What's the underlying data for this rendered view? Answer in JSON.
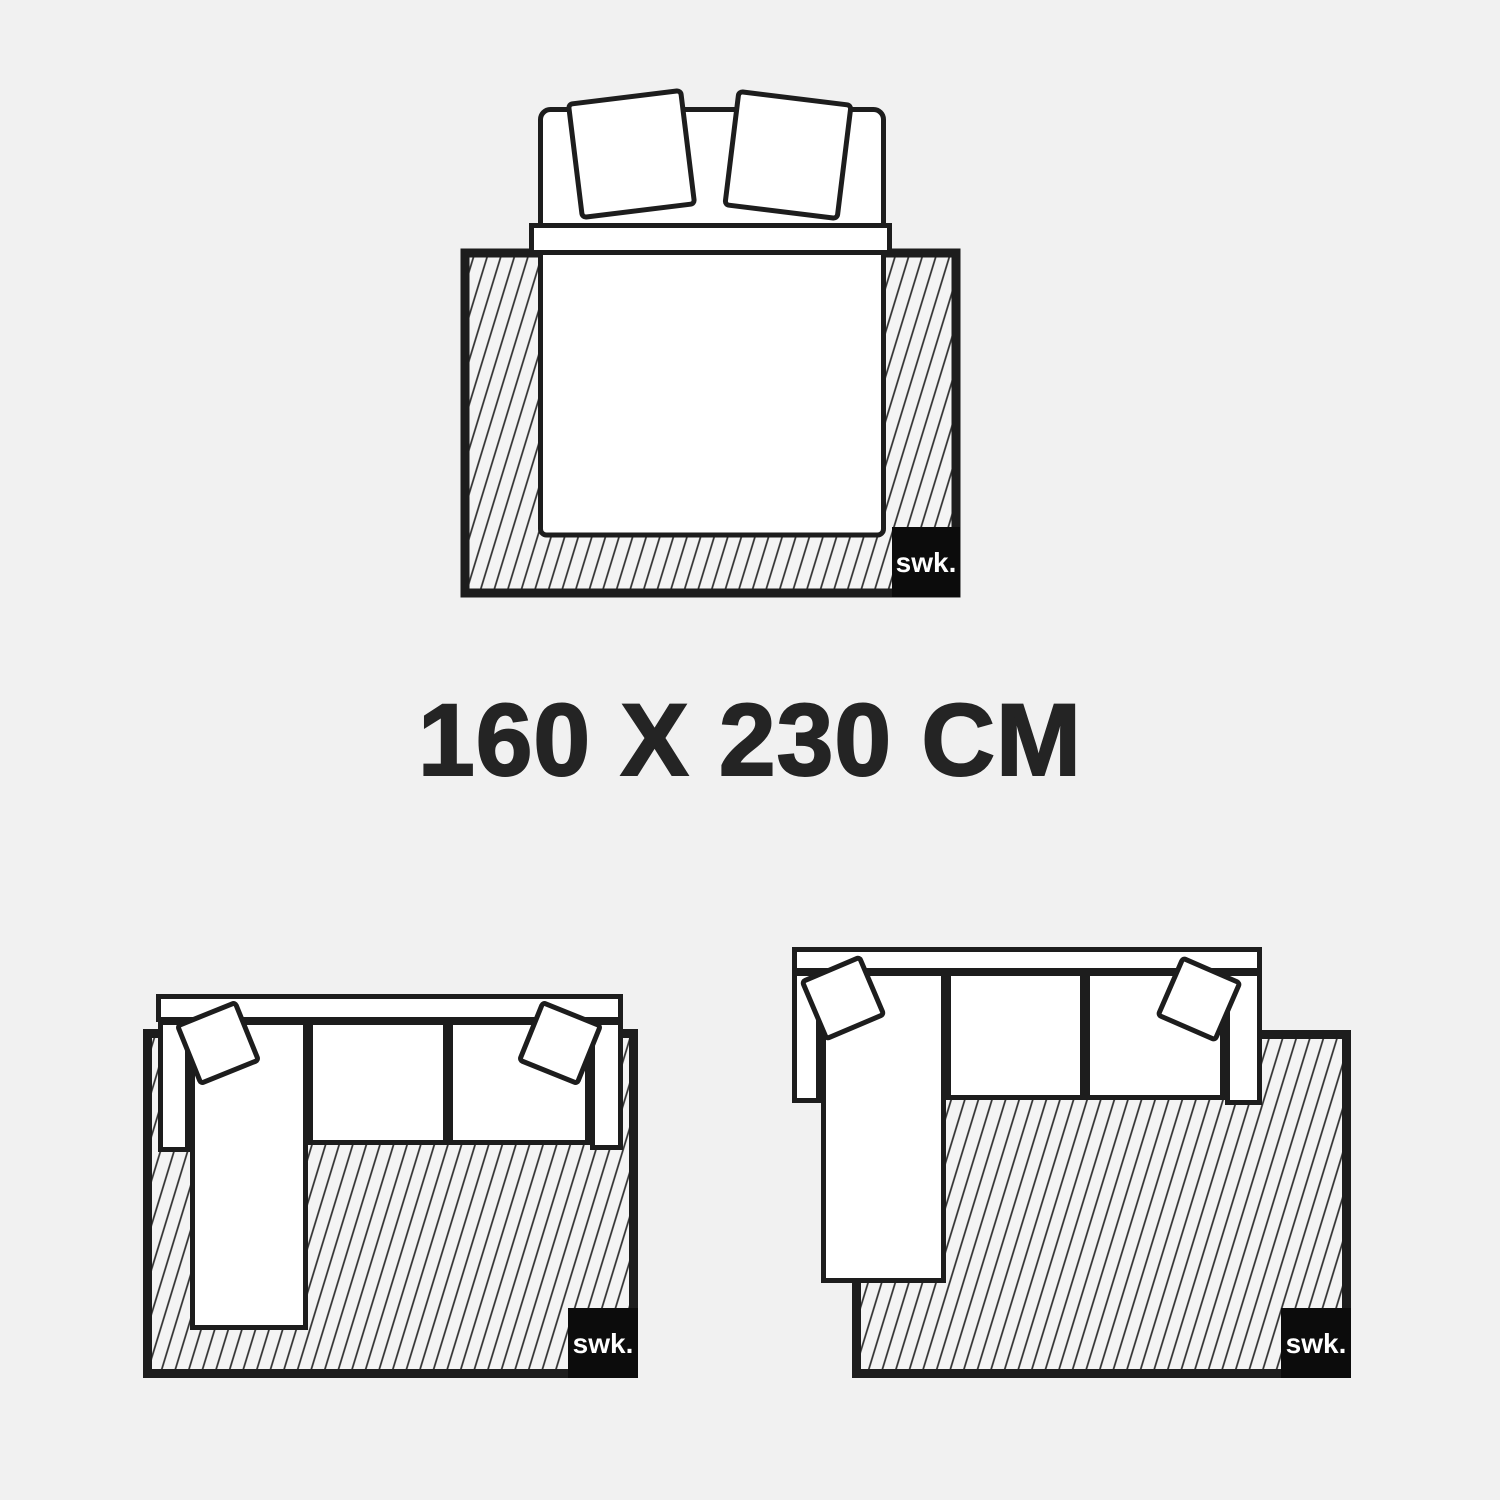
{
  "page": {
    "background_color": "#f1f1f1",
    "outline_color": "#1d1d1d",
    "hatch_line_color": "#2e2e2e",
    "hatch_fill_color": "#f4f4f4",
    "furniture_fill_color": "#ffffff"
  },
  "title": {
    "text": "160 X 230 CM",
    "color": "#242424"
  },
  "brand_badge": {
    "text": "swk.",
    "background_color": "#0c0c0c",
    "text_color": "#ffffff"
  },
  "illustrations": [
    {
      "icon": "double-bed-top-view-on-rug-icon",
      "position": "top-center"
    },
    {
      "icon": "corner-sofa-top-view-on-rug-icon",
      "position": "bottom-left"
    },
    {
      "icon": "corner-sofa-top-view-rug-offset-icon",
      "position": "bottom-right"
    }
  ]
}
